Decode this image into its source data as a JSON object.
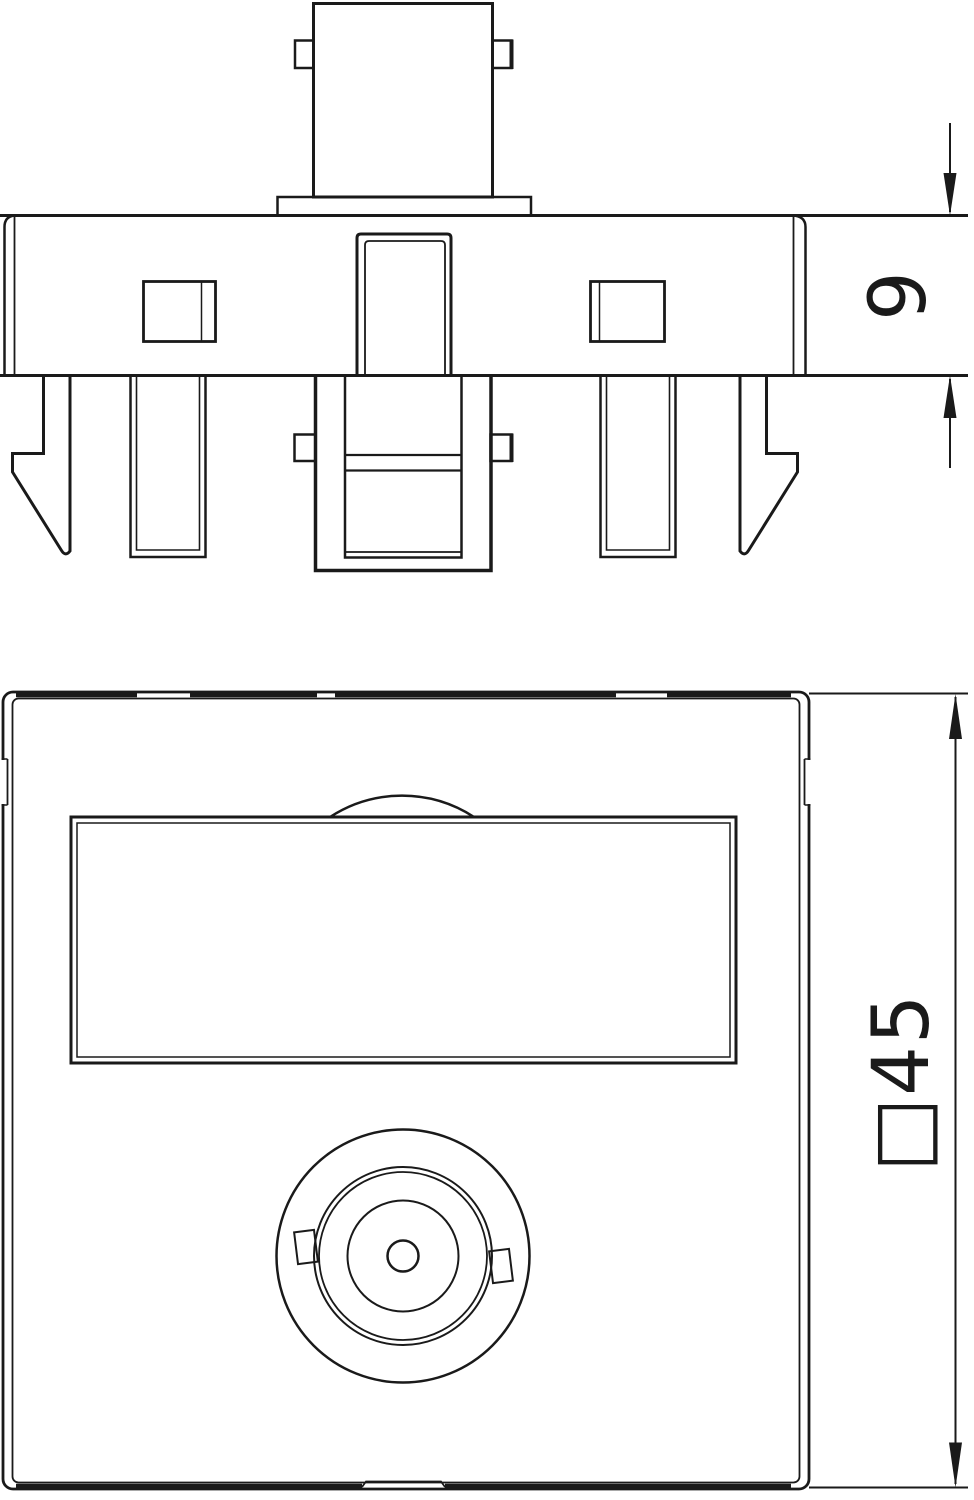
{
  "colors": {
    "background": "#ffffff",
    "line": "#1a1a1a"
  },
  "dimensions": {
    "plate_depth": {
      "label": "9"
    },
    "front_plate_size": {
      "label": "□45"
    }
  }
}
